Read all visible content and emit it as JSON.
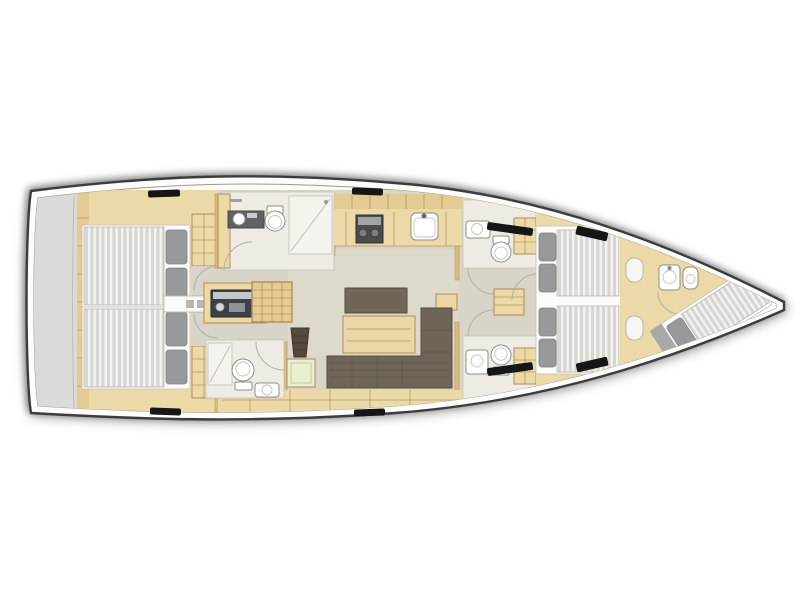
{
  "meta": {
    "title": "sailing-yacht-interior-layout-floorplan",
    "canvas": {
      "width": 800,
      "height": 601
    },
    "orientation": "bow-right-stern-left"
  },
  "palette": {
    "page_bg": "#ffffff",
    "hull_fill": "#fcfcfb",
    "hull_line": "#3c3c3c",
    "inner_line": "#9b988f",
    "platform": "#dadad8",
    "floor": "#d8d4c7",
    "floor_light": "#e2ded2",
    "bath": "#edebe3",
    "shower": "#f4f3ee",
    "wood": "#ecd9a8",
    "wood_mid": "#e4cb93",
    "wood_dark": "#d9bc7d",
    "wood_line": "#b08d55",
    "bed_frame": "#fcfcfb",
    "pillow": "#97999b",
    "pillow_line": "#7d7f81",
    "dark_furniture": "#6f6557",
    "dark_furniture_line": "#574f41",
    "table": "#ead7a6",
    "seat": "#55493b",
    "stove": "#4c4c50",
    "fixture": "#ffffff",
    "fixture_line": "#8f8c84",
    "hatch": "#161616",
    "green_unit": "#eaefd2",
    "arc_line": "#b3b0a6",
    "mattress": "#d7d6d2",
    "mattress_stripe": "#f3f3f0"
  },
  "areas": [
    {
      "id": "swim-platform",
      "name": "stern-platform"
    },
    {
      "id": "aft-cabin-port",
      "name": "aft-double-cabin-port"
    },
    {
      "id": "aft-cabin-starboard",
      "name": "aft-double-cabin-starboard"
    },
    {
      "id": "port-heads",
      "name": "port-bathroom-with-shower"
    },
    {
      "id": "starboard-aft-heads",
      "name": "starboard-aft-bathroom"
    },
    {
      "id": "galley",
      "name": "galley-with-stove-and-sink"
    },
    {
      "id": "nav-station",
      "name": "chart-table-and-instruments"
    },
    {
      "id": "companionway",
      "name": "companionway-stairs"
    },
    {
      "id": "saloon",
      "name": "saloon-table-and-l-sofa"
    },
    {
      "id": "forward-heads-port",
      "name": "forward-bathroom-port"
    },
    {
      "id": "forward-heads-starboard",
      "name": "forward-bathroom-starboard"
    },
    {
      "id": "forward-cabin",
      "name": "owner-cabin-twin-berths"
    },
    {
      "id": "bow-cabin",
      "name": "bow-crew-cabin-diagonal-berth"
    },
    {
      "id": "anchor-locker",
      "name": "bow-anchor-locker"
    }
  ]
}
